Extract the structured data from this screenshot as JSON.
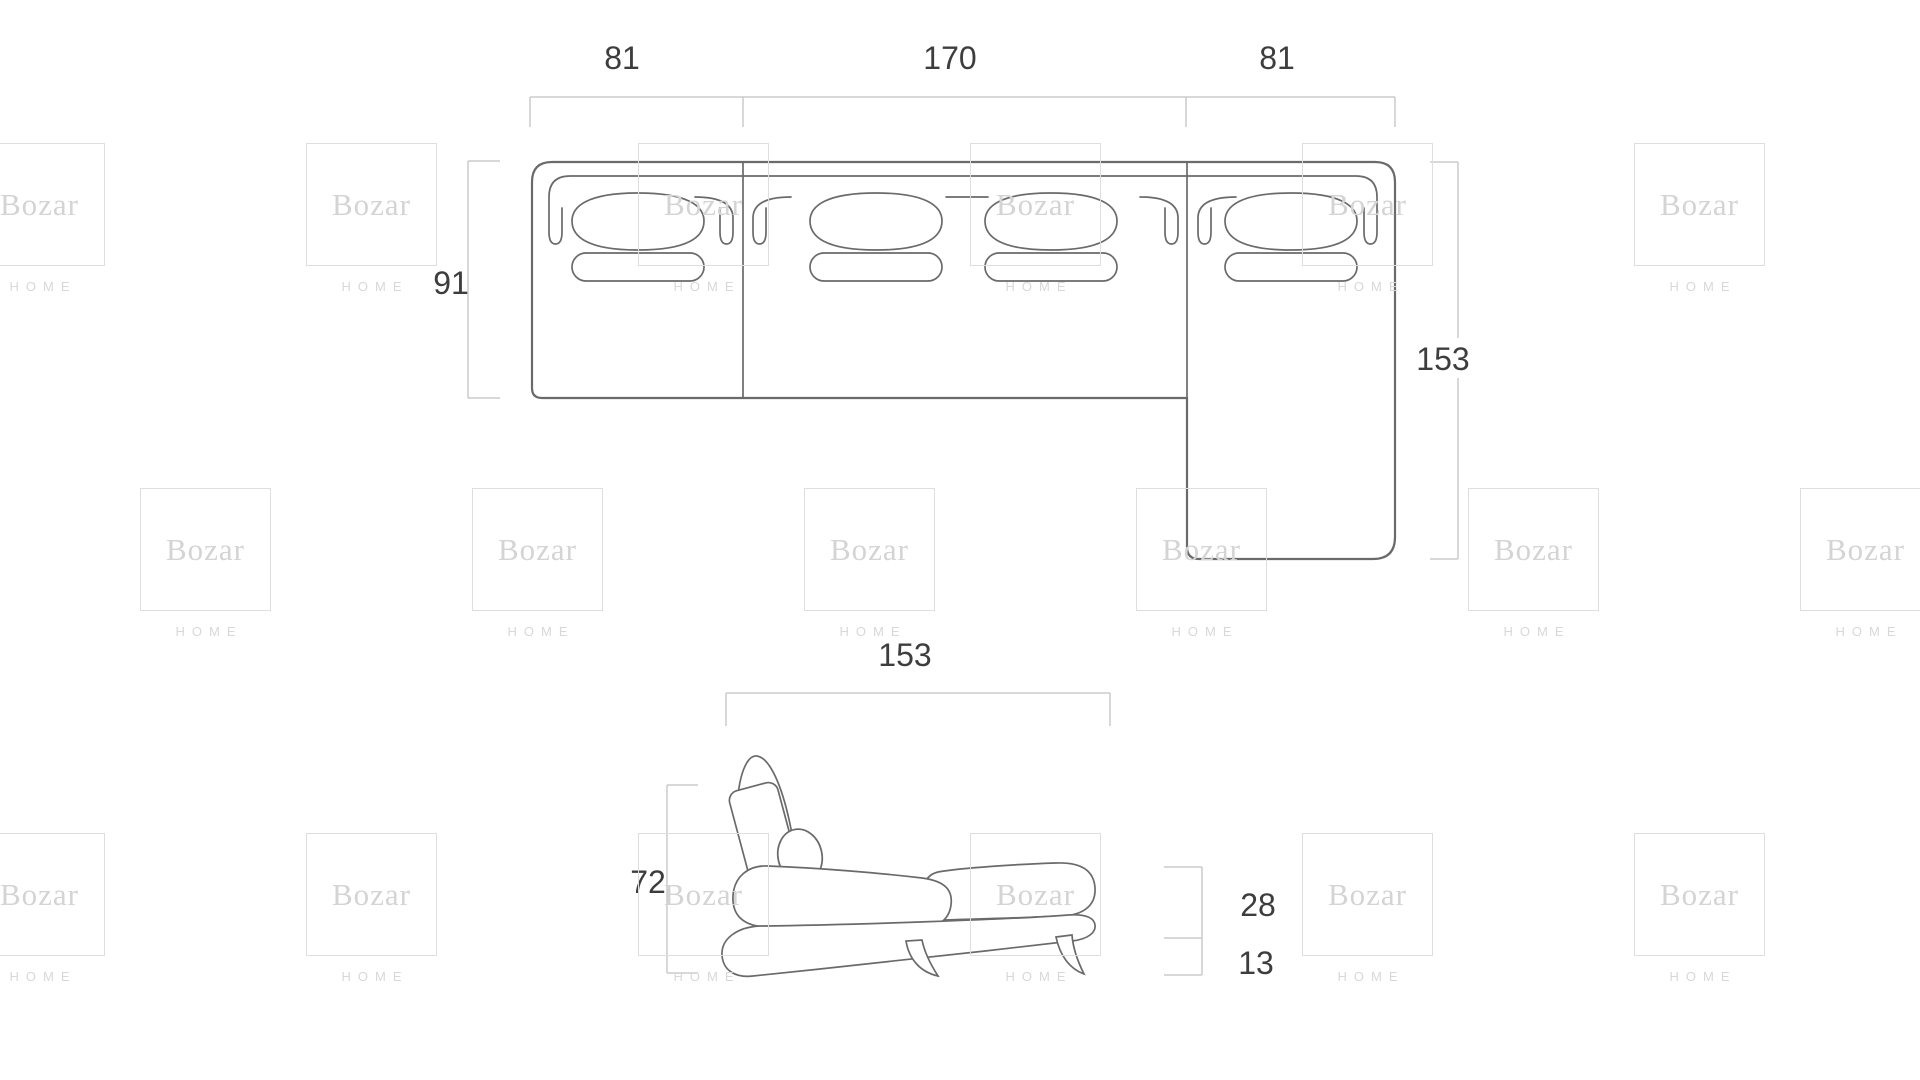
{
  "page": {
    "background": "#ffffff"
  },
  "watermark": {
    "brand": "Bozar",
    "subtext": "HOME",
    "square_border_color": "#dedede",
    "brand_color": "#d4d4d4",
    "subtext_color": "#d8d8d8",
    "grid": {
      "pitch_x": 332,
      "row_tops": [
        143,
        488,
        833
      ],
      "row_offsets": [
        -26,
        140,
        -26
      ],
      "cols": 6
    }
  },
  "diagram": {
    "unit": "cm",
    "line_color": "#6a6a6a",
    "dim_line_color": "#cbcbcb",
    "dim_text_color": "#3d3d3d",
    "top_view": {
      "section_left_width": "81",
      "section_middle_width": "170",
      "section_right_width": "81",
      "body_depth": "91",
      "chaise_length": "153"
    },
    "side_view": {
      "total_depth": "153",
      "total_height": "72",
      "seat_height": "28",
      "leg_height": "13"
    }
  }
}
